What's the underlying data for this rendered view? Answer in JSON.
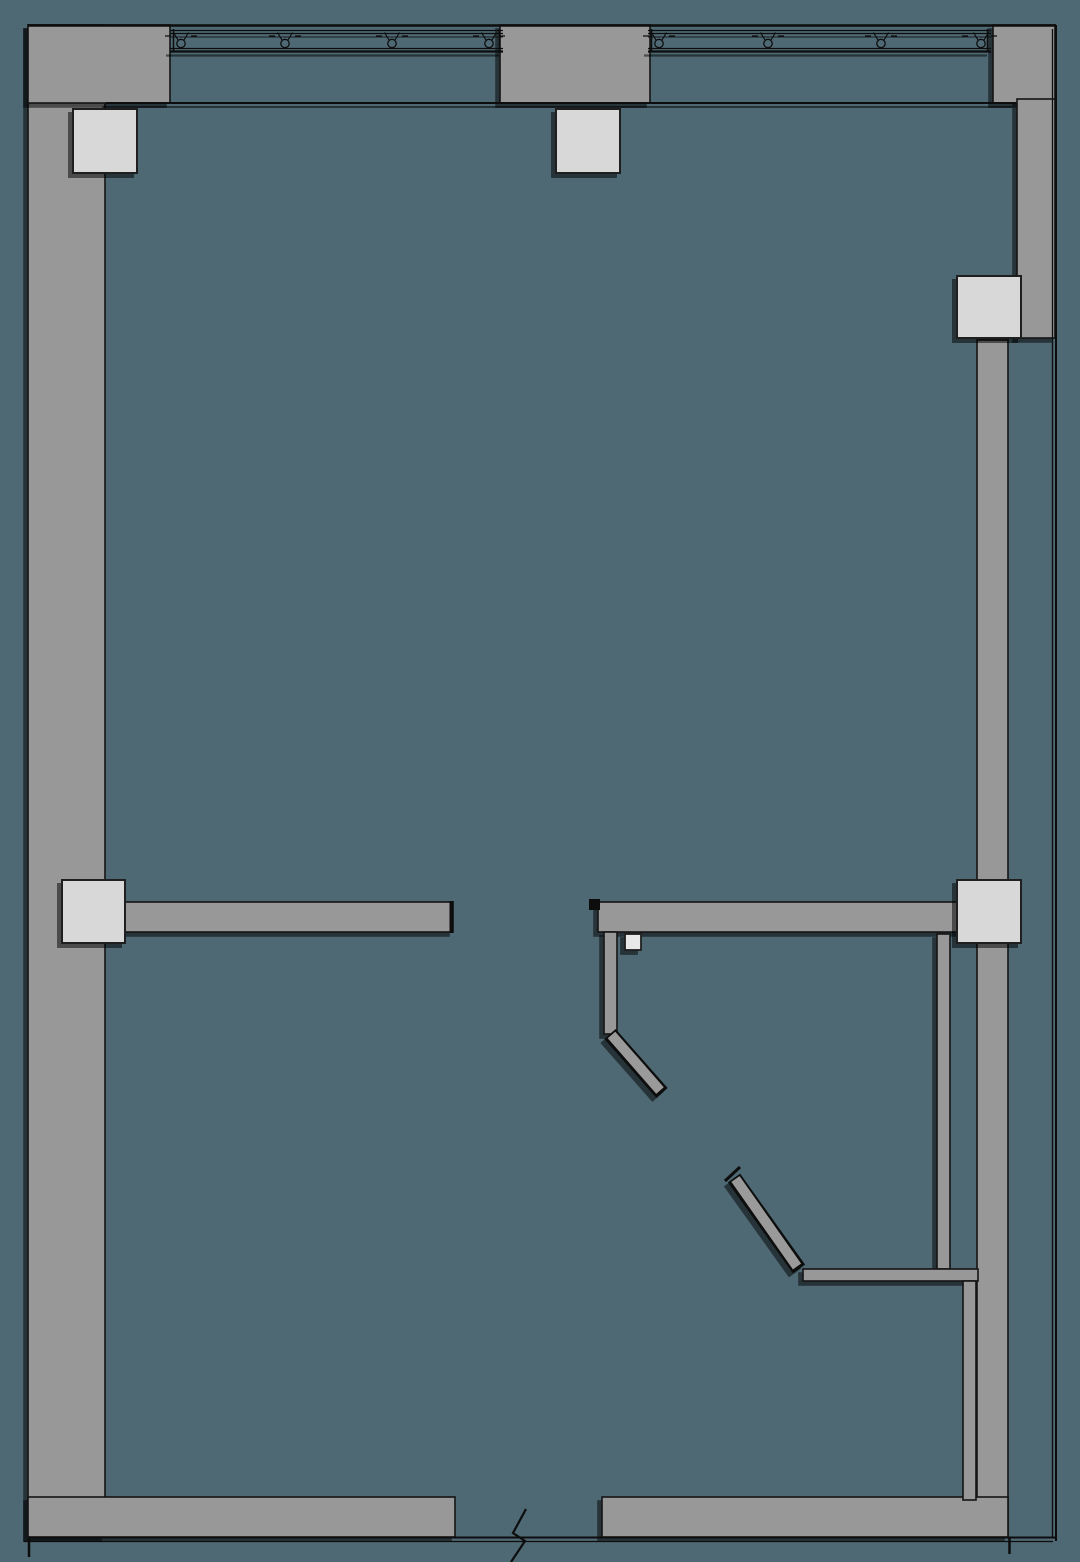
{
  "canvas": {
    "width": 1080,
    "height": 1562,
    "background": "#4e6973"
  },
  "shadow": {
    "dx": -4,
    "dy": 4,
    "opacity": 0.5,
    "color": "#000000"
  },
  "palette": {
    "wall_fill": "#989898",
    "wall_edge": "#141414",
    "column_fill": "#d8d8d8",
    "column_edge": "#1f1f1f",
    "line": "#0d0d0d",
    "door_fill": "#9a9a9a"
  },
  "items": [
    {
      "name": "canvas-background",
      "tag": "rect",
      "attrs": {
        "x": 0,
        "y": 0,
        "width": 1080,
        "height": 1562,
        "fill": "#4e6973"
      }
    },
    {
      "name": "wall-left-band",
      "tag": "rect",
      "shadow": true,
      "attrs": {
        "x": 28,
        "y": 25,
        "width": 77,
        "height": 1512,
        "fill": "#989898",
        "stroke": "#141414",
        "stroke-width": 1.6
      }
    },
    {
      "name": "wall-top-left-corner",
      "tag": "rect",
      "shadow": true,
      "attrs": {
        "x": 28,
        "y": 25,
        "width": 142,
        "height": 78,
        "fill": "#989898",
        "stroke": "#141414",
        "stroke-width": 1.6
      }
    },
    {
      "name": "wall-top-center-pier",
      "tag": "rect",
      "shadow": true,
      "attrs": {
        "x": 500,
        "y": 25,
        "width": 150,
        "height": 78,
        "fill": "#989898",
        "stroke": "#141414",
        "stroke-width": 1.6
      }
    },
    {
      "name": "wall-top-right-corner",
      "tag": "rect",
      "shadow": true,
      "attrs": {
        "x": 993,
        "y": 25,
        "width": 62,
        "height": 78,
        "fill": "#989898",
        "stroke": "#141414",
        "stroke-width": 1.6
      }
    },
    {
      "name": "wall-right-upper",
      "tag": "rect",
      "shadow": true,
      "attrs": {
        "x": 1017,
        "y": 99,
        "width": 38,
        "height": 239,
        "fill": "#989898",
        "stroke": "#141414",
        "stroke-width": 1.6
      }
    },
    {
      "name": "wall-right-inner",
      "tag": "rect",
      "attrs": {
        "x": 977,
        "y": 340,
        "width": 31,
        "height": 1197,
        "fill": "#989898",
        "stroke": "#141414",
        "stroke-width": 1.6
      }
    },
    {
      "name": "wall-bottom-left",
      "tag": "rect",
      "shadow": true,
      "attrs": {
        "x": 28,
        "y": 1497,
        "width": 427,
        "height": 40,
        "fill": "#989898",
        "stroke": "#141414",
        "stroke-width": 1.6
      }
    },
    {
      "name": "wall-bottom-right",
      "tag": "rect",
      "shadow": true,
      "attrs": {
        "x": 602,
        "y": 1497,
        "width": 406,
        "height": 40,
        "fill": "#989898",
        "stroke": "#141414",
        "stroke-width": 1.6
      }
    },
    {
      "name": "wall-main-left-segment",
      "tag": "rect",
      "shadow": true,
      "attrs": {
        "x": 106,
        "y": 902,
        "width": 347,
        "height": 30,
        "fill": "#989898",
        "stroke": "#141414",
        "stroke-width": 1.6
      }
    },
    {
      "name": "wall-main-right-segment",
      "tag": "rect",
      "shadow": true,
      "attrs": {
        "x": 598,
        "y": 902,
        "width": 382,
        "height": 30,
        "fill": "#989898",
        "stroke": "#141414",
        "stroke-width": 1.6
      }
    },
    {
      "name": "wall-partition-door1",
      "tag": "rect",
      "shadow": true,
      "attrs": {
        "x": 604,
        "y": 932,
        "width": 13,
        "height": 102,
        "fill": "#989898",
        "stroke": "#141414",
        "stroke-width": 1.6
      }
    },
    {
      "name": "wall-shaft-upper",
      "tag": "rect",
      "shadow": true,
      "attrs": {
        "x": 937,
        "y": 934,
        "width": 13,
        "height": 335,
        "fill": "#989898",
        "stroke": "#141414",
        "stroke-width": 1.6
      }
    },
    {
      "name": "wall-shaft-horizontal",
      "tag": "rect",
      "shadow": true,
      "attrs": {
        "x": 803,
        "y": 1269,
        "width": 175,
        "height": 12,
        "fill": "#989898",
        "stroke": "#141414",
        "stroke-width": 1.6
      }
    },
    {
      "name": "wall-shaft-lower",
      "tag": "rect",
      "attrs": {
        "x": 963,
        "y": 1281,
        "width": 13,
        "height": 219,
        "fill": "#989898",
        "stroke": "#141414",
        "stroke-width": 1.6
      }
    },
    {
      "name": "top-outer-edge-line",
      "tag": "line",
      "attrs": {
        "x1": 28,
        "y1": 25.5,
        "x2": 1056,
        "y2": 25.5,
        "stroke": "#0d0d0d",
        "stroke-width": 2.6
      }
    },
    {
      "name": "window-sill-line",
      "tag": "line",
      "shadow": true,
      "attrs": {
        "x1": 106,
        "y1": 103,
        "x2": 1016,
        "y2": 103,
        "stroke": "#0d0d0d",
        "stroke-width": 2
      }
    },
    {
      "name": "window-band-a-line-1",
      "tag": "line",
      "attrs": {
        "x1": 170,
        "y1": 30.5,
        "x2": 503,
        "y2": 30.5,
        "stroke": "#0d0d0d",
        "stroke-width": 1.3
      }
    },
    {
      "name": "window-band-a-line-2",
      "tag": "line",
      "attrs": {
        "x1": 170,
        "y1": 33.5,
        "x2": 503,
        "y2": 33.5,
        "stroke": "#0d0d0d",
        "stroke-width": 1.3
      }
    },
    {
      "name": "window-band-a-line-3",
      "tag": "line",
      "attrs": {
        "x1": 170,
        "y1": 37,
        "x2": 503,
        "y2": 37,
        "stroke": "#0d0d0d",
        "stroke-width": 1,
        "opacity": 0.85
      }
    },
    {
      "name": "window-band-a-line-4",
      "tag": "line",
      "attrs": {
        "x1": 170,
        "y1": 48.5,
        "x2": 503,
        "y2": 48.5,
        "stroke": "#0d0d0d",
        "stroke-width": 1.3
      }
    },
    {
      "name": "window-band-a-line-5",
      "tag": "line",
      "shadow": true,
      "attrs": {
        "x1": 170,
        "y1": 51.5,
        "x2": 503,
        "y2": 51.5,
        "stroke": "#0d0d0d",
        "stroke-width": 2.2
      }
    },
    {
      "name": "window-band-a-start-tick",
      "tag": "line",
      "attrs": {
        "x1": 173.5,
        "y1": 29,
        "x2": 173.5,
        "y2": 52,
        "stroke": "#0d0d0d",
        "stroke-width": 1.5
      }
    },
    {
      "name": "window-band-a-end-tick",
      "tag": "line",
      "attrs": {
        "x1": 499.5,
        "y1": 29,
        "x2": 499.5,
        "y2": 52,
        "stroke": "#0d0d0d",
        "stroke-width": 1.5
      }
    },
    {
      "name": "window-band-b-line-1",
      "tag": "line",
      "attrs": {
        "x1": 648,
        "y1": 30.5,
        "x2": 991,
        "y2": 30.5,
        "stroke": "#0d0d0d",
        "stroke-width": 1.3
      }
    },
    {
      "name": "window-band-b-line-2",
      "tag": "line",
      "attrs": {
        "x1": 648,
        "y1": 33.5,
        "x2": 991,
        "y2": 33.5,
        "stroke": "#0d0d0d",
        "stroke-width": 1.3
      }
    },
    {
      "name": "window-band-b-line-3",
      "tag": "line",
      "attrs": {
        "x1": 648,
        "y1": 37,
        "x2": 991,
        "y2": 37,
        "stroke": "#0d0d0d",
        "stroke-width": 1,
        "opacity": 0.85
      }
    },
    {
      "name": "window-band-b-line-4",
      "tag": "line",
      "attrs": {
        "x1": 648,
        "y1": 48.5,
        "x2": 991,
        "y2": 48.5,
        "stroke": "#0d0d0d",
        "stroke-width": 1.3
      }
    },
    {
      "name": "window-band-b-line-5",
      "tag": "line",
      "shadow": true,
      "attrs": {
        "x1": 648,
        "y1": 51.5,
        "x2": 991,
        "y2": 51.5,
        "stroke": "#0d0d0d",
        "stroke-width": 2.2
      }
    },
    {
      "name": "window-band-b-start-tick",
      "tag": "line",
      "attrs": {
        "x1": 651.5,
        "y1": 29,
        "x2": 651.5,
        "y2": 52,
        "stroke": "#0d0d0d",
        "stroke-width": 1.5
      }
    },
    {
      "name": "window-band-b-end-tick",
      "tag": "line",
      "attrs": {
        "x1": 987.5,
        "y1": 29,
        "x2": 987.5,
        "y2": 52,
        "stroke": "#0d0d0d",
        "stroke-width": 1.5
      }
    },
    {
      "name": "mullion-symbol-circle-1",
      "tag": "circle",
      "attrs": {
        "cx": 181,
        "cy": 43.5,
        "r": 4.2,
        "fill": "none",
        "stroke": "#0d0d0d",
        "stroke-width": 1.3
      }
    },
    {
      "name": "mullion-symbol-arms-1",
      "tag": "path",
      "attrs": {
        "d": "M178,40 L173.5,32.5 M184,40 L188.5,32.5 M165,36 l6,0 M191,36 l6,0",
        "fill": "none",
        "stroke": "#0d0d0d",
        "stroke-width": 1.2
      }
    },
    {
      "name": "mullion-symbol-circle-2",
      "tag": "circle",
      "attrs": {
        "cx": 285,
        "cy": 43.5,
        "r": 4.2,
        "fill": "none",
        "stroke": "#0d0d0d",
        "stroke-width": 1.3
      }
    },
    {
      "name": "mullion-symbol-arms-2",
      "tag": "path",
      "attrs": {
        "d": "M282,40 L277.5,32.5 M288,40 L292.5,32.5 M269,36 l6,0 M295,36 l6,0",
        "fill": "none",
        "stroke": "#0d0d0d",
        "stroke-width": 1.2
      }
    },
    {
      "name": "mullion-symbol-circle-3",
      "tag": "circle",
      "attrs": {
        "cx": 392,
        "cy": 43.5,
        "r": 4.2,
        "fill": "none",
        "stroke": "#0d0d0d",
        "stroke-width": 1.3
      }
    },
    {
      "name": "mullion-symbol-arms-3",
      "tag": "path",
      "attrs": {
        "d": "M389,40 L384.5,32.5 M395,40 L399.5,32.5 M376,36 l6,0 M402,36 l6,0",
        "fill": "none",
        "stroke": "#0d0d0d",
        "stroke-width": 1.2
      }
    },
    {
      "name": "mullion-symbol-circle-4",
      "tag": "circle",
      "attrs": {
        "cx": 489,
        "cy": 43.5,
        "r": 4.2,
        "fill": "none",
        "stroke": "#0d0d0d",
        "stroke-width": 1.3
      }
    },
    {
      "name": "mullion-symbol-arms-4",
      "tag": "path",
      "attrs": {
        "d": "M486,40 L481.5,32.5 M492,40 L496.5,32.5 M473,36 l6,0 M499,36 l6,0",
        "fill": "none",
        "stroke": "#0d0d0d",
        "stroke-width": 1.2
      }
    },
    {
      "name": "mullion-symbol-circle-5",
      "tag": "circle",
      "attrs": {
        "cx": 659,
        "cy": 43.5,
        "r": 4.2,
        "fill": "none",
        "stroke": "#0d0d0d",
        "stroke-width": 1.3
      }
    },
    {
      "name": "mullion-symbol-arms-5",
      "tag": "path",
      "attrs": {
        "d": "M656,40 L651.5,32.5 M662,40 L666.5,32.5 M643,36 l6,0 M669,36 l6,0",
        "fill": "none",
        "stroke": "#0d0d0d",
        "stroke-width": 1.2
      }
    },
    {
      "name": "mullion-symbol-circle-6",
      "tag": "circle",
      "attrs": {
        "cx": 768,
        "cy": 43.5,
        "r": 4.2,
        "fill": "none",
        "stroke": "#0d0d0d",
        "stroke-width": 1.3
      }
    },
    {
      "name": "mullion-symbol-arms-6",
      "tag": "path",
      "attrs": {
        "d": "M765,40 L760.5,32.5 M771,40 L775.5,32.5 M752,36 l6,0 M778,36 l6,0",
        "fill": "none",
        "stroke": "#0d0d0d",
        "stroke-width": 1.2
      }
    },
    {
      "name": "mullion-symbol-circle-7",
      "tag": "circle",
      "attrs": {
        "cx": 881,
        "cy": 43.5,
        "r": 4.2,
        "fill": "none",
        "stroke": "#0d0d0d",
        "stroke-width": 1.3
      }
    },
    {
      "name": "mullion-symbol-arms-7",
      "tag": "path",
      "attrs": {
        "d": "M878,40 L873.5,32.5 M884,40 L888.5,32.5 M865,36 l6,0 M891,36 l6,0",
        "fill": "none",
        "stroke": "#0d0d0d",
        "stroke-width": 1.2
      }
    },
    {
      "name": "mullion-symbol-circle-8",
      "tag": "circle",
      "attrs": {
        "cx": 981,
        "cy": 43.5,
        "r": 4.2,
        "fill": "none",
        "stroke": "#0d0d0d",
        "stroke-width": 1.3
      }
    },
    {
      "name": "mullion-symbol-arms-8",
      "tag": "path",
      "attrs": {
        "d": "M978,40 L973.5,32.5 M984,40 L988.5,32.5 M962,36 l6,0 M991,36 l6,0",
        "fill": "none",
        "stroke": "#0d0d0d",
        "stroke-width": 1.2
      }
    },
    {
      "name": "right-boundary-line-outer",
      "tag": "line",
      "attrs": {
        "x1": 1056,
        "y1": 25,
        "x2": 1056,
        "y2": 1541,
        "stroke": "#0d0d0d",
        "stroke-width": 2
      }
    },
    {
      "name": "right-boundary-line-inner",
      "tag": "line",
      "attrs": {
        "x1": 1052.5,
        "y1": 29,
        "x2": 1052.5,
        "y2": 1537,
        "stroke": "#0d0d0d",
        "stroke-width": 1.3
      }
    },
    {
      "name": "bottom-boundary-line-upper",
      "tag": "line",
      "attrs": {
        "x1": 28,
        "y1": 1537.5,
        "x2": 1057,
        "y2": 1537.5,
        "stroke": "#0d0d0d",
        "stroke-width": 2
      }
    },
    {
      "name": "bottom-boundary-line-lower",
      "tag": "line",
      "attrs": {
        "x1": 24,
        "y1": 1541.5,
        "x2": 1053,
        "y2": 1541.5,
        "stroke": "#0d0d0d",
        "stroke-width": 1.3
      }
    },
    {
      "name": "bottom-left-corner-tick",
      "tag": "line",
      "attrs": {
        "x1": 29,
        "y1": 1538,
        "x2": 29,
        "y2": 1557,
        "stroke": "#0d0d0d",
        "stroke-width": 2.5
      }
    },
    {
      "name": "bottom-right-corner-tick",
      "tag": "line",
      "attrs": {
        "x1": 1009.5,
        "y1": 1538,
        "x2": 1009.5,
        "y2": 1554,
        "stroke": "#0d0d0d",
        "stroke-width": 2.5
      }
    },
    {
      "name": "main-wall-left-end-cap",
      "tag": "line",
      "attrs": {
        "x1": 451.5,
        "y1": 901,
        "x2": 451.5,
        "y2": 933,
        "stroke": "#0d0d0d",
        "stroke-width": 4
      }
    },
    {
      "name": "main-wall-right-start-cap",
      "tag": "rect",
      "attrs": {
        "x": 589,
        "y": 899,
        "width": 11,
        "height": 11,
        "fill": "#0d0d0d"
      }
    },
    {
      "name": "door-leaf-1-outline",
      "tag": "line",
      "shadow": true,
      "attrs": {
        "x1": 610,
        "y1": 1034,
        "x2": 662,
        "y2": 1093,
        "stroke": "#0d0d0d",
        "stroke-width": 15
      }
    },
    {
      "name": "door-leaf-1-fill",
      "tag": "line",
      "attrs": {
        "x1": 611.5,
        "y1": 1035,
        "x2": 660,
        "y2": 1090.5,
        "stroke": "#9a9a9a",
        "stroke-width": 10
      }
    },
    {
      "name": "door-leaf-2-outline",
      "tag": "line",
      "shadow": true,
      "attrs": {
        "x1": 734,
        "y1": 1178,
        "x2": 799,
        "y2": 1269,
        "stroke": "#0d0d0d",
        "stroke-width": 15
      }
    },
    {
      "name": "door-leaf-2-fill",
      "tag": "line",
      "attrs": {
        "x1": 735.5,
        "y1": 1179,
        "x2": 797,
        "y2": 1266.5,
        "stroke": "#9a9a9a",
        "stroke-width": 10
      }
    },
    {
      "name": "door-leaf-2-tip-flag",
      "tag": "line",
      "attrs": {
        "x1": 725,
        "y1": 1181,
        "x2": 740,
        "y2": 1167,
        "stroke": "#0d0d0d",
        "stroke-width": 3
      }
    },
    {
      "name": "column-top-left",
      "tag": "rect",
      "shadow": true,
      "attrs": {
        "x": 73,
        "y": 109,
        "width": 64,
        "height": 64,
        "fill": "#d8d8d8",
        "stroke": "#1f1f1f",
        "stroke-width": 2
      }
    },
    {
      "name": "column-top-center",
      "tag": "rect",
      "shadow": true,
      "attrs": {
        "x": 556,
        "y": 109,
        "width": 64,
        "height": 64,
        "fill": "#d8d8d8",
        "stroke": "#1f1f1f",
        "stroke-width": 2
      }
    },
    {
      "name": "column-right-upper",
      "tag": "rect",
      "shadow": true,
      "attrs": {
        "x": 957,
        "y": 276,
        "width": 64,
        "height": 62,
        "fill": "#d8d8d8",
        "stroke": "#1f1f1f",
        "stroke-width": 2
      }
    },
    {
      "name": "column-left-middle",
      "tag": "rect",
      "shadow": true,
      "attrs": {
        "x": 62,
        "y": 880,
        "width": 63,
        "height": 63,
        "fill": "#d8d8d8",
        "stroke": "#1f1f1f",
        "stroke-width": 2
      }
    },
    {
      "name": "column-right-middle",
      "tag": "rect",
      "shadow": true,
      "attrs": {
        "x": 957,
        "y": 880,
        "width": 64,
        "height": 63,
        "fill": "#d8d8d8",
        "stroke": "#1f1f1f",
        "stroke-width": 2
      }
    },
    {
      "name": "door-jamb-block",
      "tag": "rect",
      "shadow": true,
      "attrs": {
        "x": 625,
        "y": 934,
        "width": 16,
        "height": 16,
        "fill": "#e8e8e8",
        "stroke": "#1f1f1f",
        "stroke-width": 1.8
      }
    },
    {
      "name": "break-symbol",
      "tag": "polyline",
      "attrs": {
        "points": "526,1509 513,1533 525,1541 511,1562",
        "fill": "none",
        "stroke": "#0d0d0d",
        "stroke-width": 2.2
      }
    }
  ]
}
